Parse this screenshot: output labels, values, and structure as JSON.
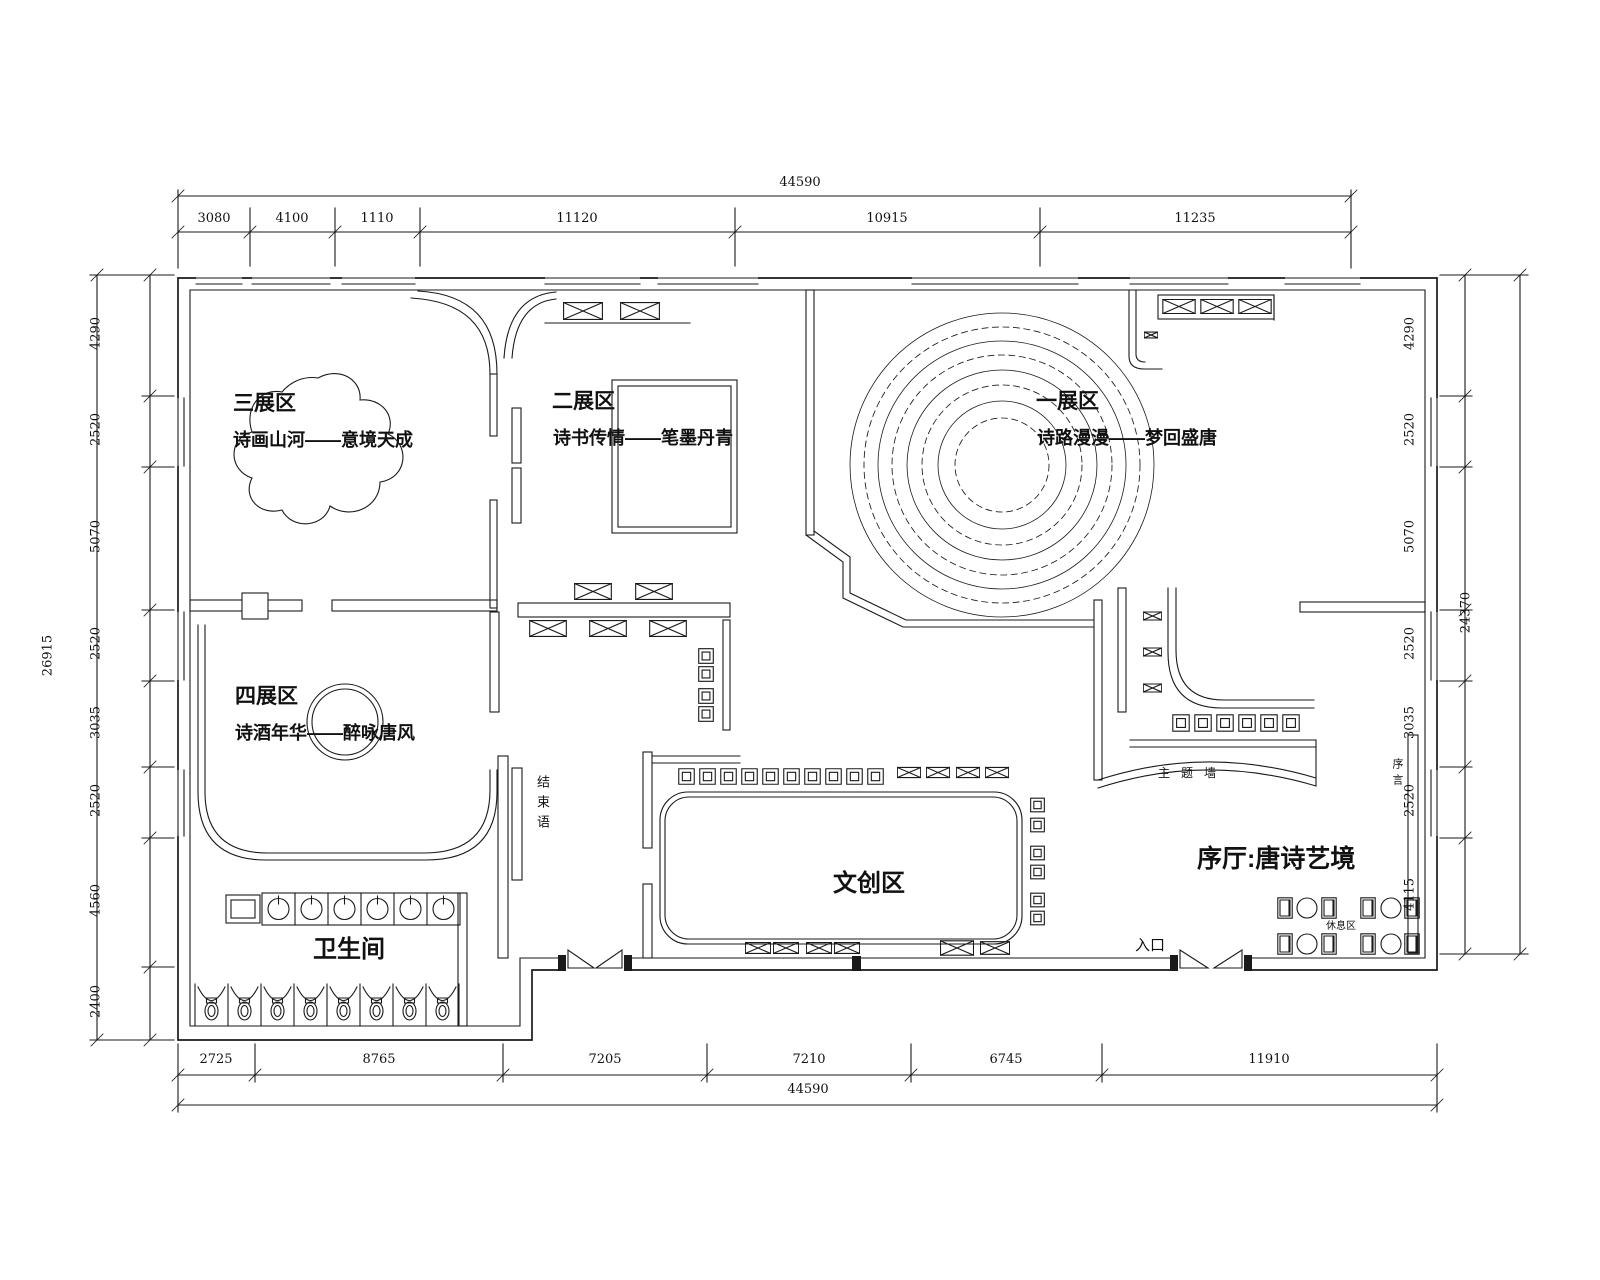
{
  "zones": {
    "zone1": {
      "title": "一展区",
      "subtitle": "诗路漫漫——梦回盛唐"
    },
    "zone2": {
      "title": "二展区",
      "subtitle": "诗书传情——笔墨丹青"
    },
    "zone3": {
      "title": "三展区",
      "subtitle": "诗画山河——意境天成"
    },
    "zone4": {
      "title": "四展区",
      "subtitle": "诗酒年华——醉咏唐风"
    },
    "cultural": {
      "title": "文创区"
    },
    "restroom": {
      "title": "卫生间"
    },
    "lobby": {
      "title": "序厅:唐诗艺境"
    }
  },
  "annotations": {
    "entrance": "入口",
    "theme_wall": "主题墙",
    "rest_area": "休息区",
    "conclusion": "结束语",
    "preface": "序言"
  },
  "dims": {
    "top": {
      "total": "44590",
      "segments": [
        "3080",
        "4100",
        "1110",
        "11120",
        "10915",
        "11235"
      ]
    },
    "bottom": {
      "total": "44590",
      "segments": [
        "2725",
        "8765",
        "7205",
        "7210",
        "6745",
        "11910"
      ]
    },
    "left": {
      "total": "26915",
      "segments": [
        "4290",
        "2520",
        "5070",
        "2520",
        "3035",
        "2520",
        "4560",
        "2400"
      ]
    },
    "right": {
      "total": "24370",
      "segments": [
        "4290",
        "2520",
        "5070",
        "2520",
        "3035",
        "2520",
        "4115"
      ]
    }
  },
  "colors": {
    "line": "#1a1a1a",
    "background": "#ffffff"
  }
}
